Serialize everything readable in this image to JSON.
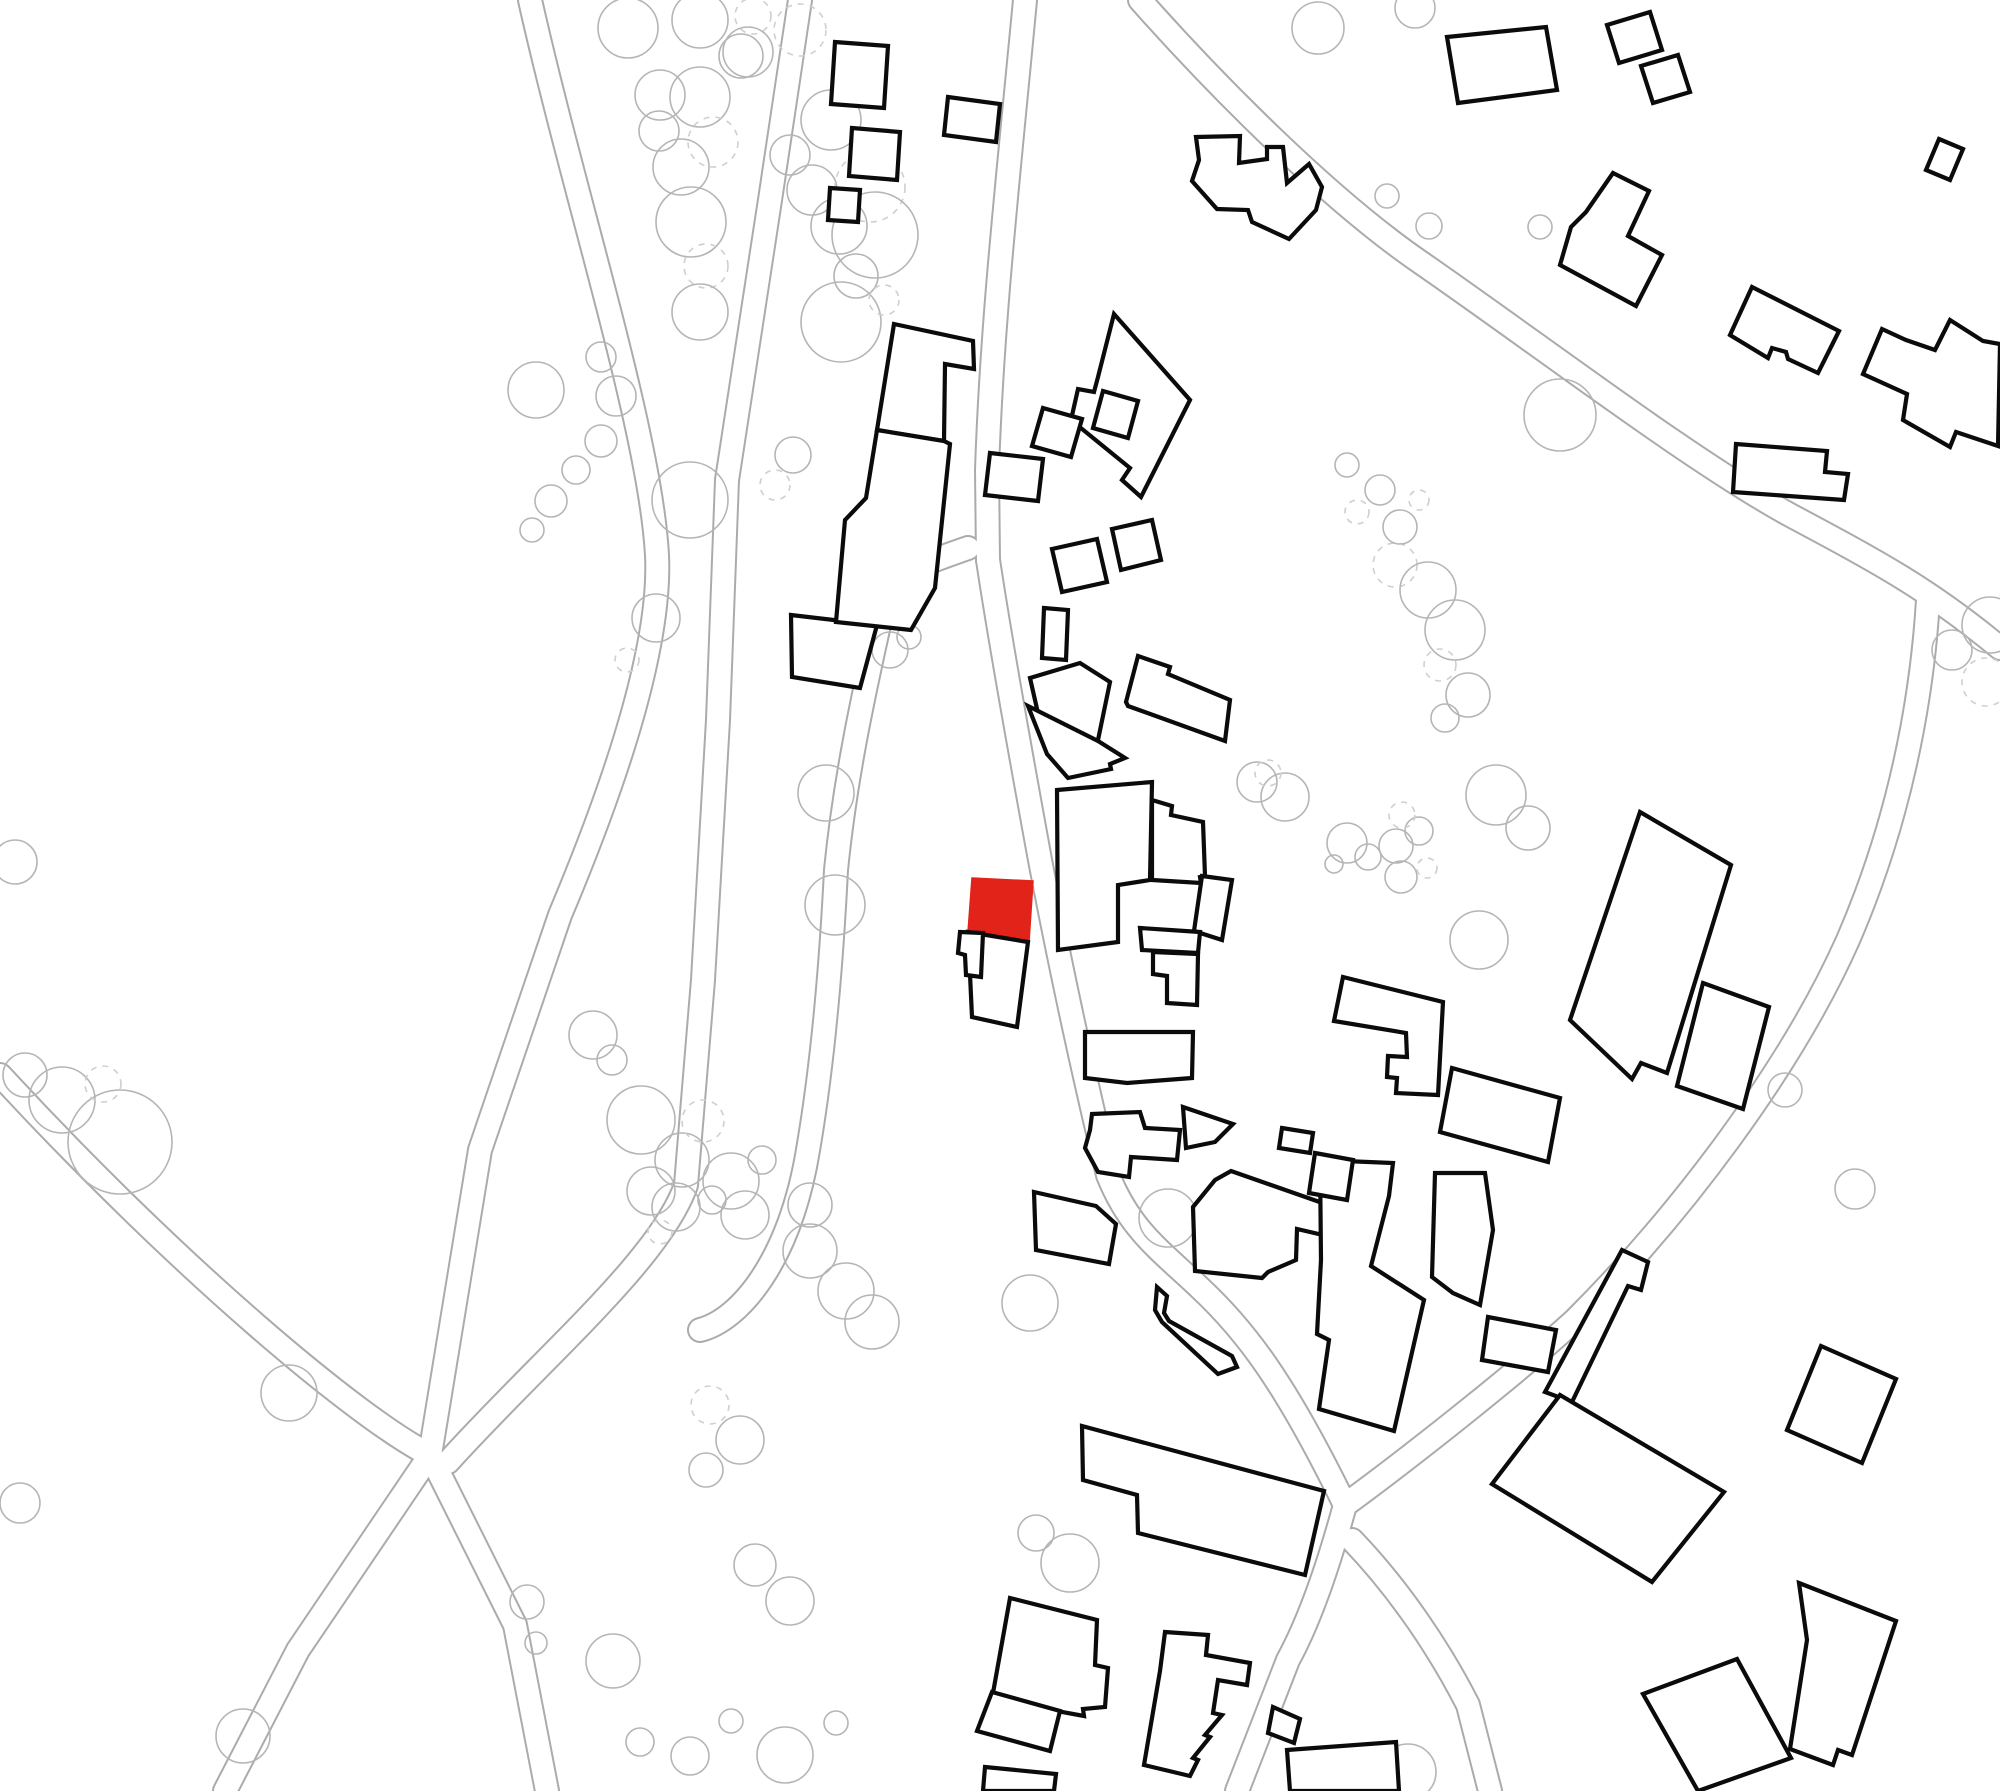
{
  "map": {
    "width": 2000,
    "height": 1791,
    "background": "#ffffff",
    "building_fill": "#ffffff",
    "building_outline_color": "#0b0b0b",
    "building_outline_width": 4.2,
    "highlight_fill": "#e2231a",
    "road_edge_color": "#ababab",
    "road_casing_width": 26,
    "road_inner_width": 22,
    "tree_color": "#b5b5b5",
    "tree_dashed_color": "#cfcfcf",
    "tree_stroke_width": 1.6,
    "tree_dash_pattern": "6 6"
  },
  "roads": [
    {
      "name": "road-west-main",
      "d": "M530,0 C575,200 650,430 657,555 C662,660 600,820 560,915 L480,1150 L430,1455 L298,1650 L225,1791"
    },
    {
      "name": "road-west-branch-se",
      "d": "M430,1455 L515,1625 L547,1791"
    },
    {
      "name": "road-west-branch-nw",
      "d": "M430,1455 C360,1420 180,1270 0,1075"
    },
    {
      "name": "road-village-west",
      "d": "M800,0 L770,200 L727,480 L718,720 L703,980 L686,1185 C660,1260 540,1360 448,1462"
    },
    {
      "name": "road-village-north",
      "d": "M1025,0 C1008,180 992,320 987,470 L988,560"
    },
    {
      "name": "road-village-main",
      "d": "M988,560 C1000,640 1018,740 1040,860 C1062,975 1085,1080 1108,1175 C1130,1230 1160,1250 1200,1288 C1245,1330 1285,1382 1345,1505"
    },
    {
      "name": "road-village-lane",
      "d": "M968,548 C920,565 890,575 885,598 C862,700 845,780 836,870 C830,990 820,1080 808,1150 C790,1260 740,1320 700,1330"
    },
    {
      "name": "road-village-south",
      "d": "M1345,1505 C1330,1560 1310,1620 1288,1660 L1237,1791"
    },
    {
      "name": "road-northeast",
      "d": "M1345,1505 C1420,1450 1520,1370 1575,1320 C1680,1215 1790,1070 1848,940 C1900,820 1922,700 1928,600"
    },
    {
      "name": "road-top-diagonal",
      "d": "M1140,0 C1220,90 1330,200 1420,262 C1540,345 1690,460 1790,515 C1880,563 1930,590 2000,648"
    },
    {
      "name": "road-southeast-stub",
      "d": "M1352,1540 C1400,1590 1440,1650 1468,1705 L1490,1791"
    }
  ],
  "trees": [
    {
      "x": 628,
      "y": 28,
      "r": 30
    },
    {
      "x": 660,
      "y": 95,
      "r": 25
    },
    {
      "x": 700,
      "y": 20,
      "r": 28
    },
    {
      "x": 741,
      "y": 56,
      "r": 22
    },
    {
      "x": 753,
      "y": 16,
      "r": 18,
      "dashed": true
    },
    {
      "x": 700,
      "y": 97,
      "r": 30
    },
    {
      "x": 713,
      "y": 142,
      "r": 25,
      "dashed": true
    },
    {
      "x": 681,
      "y": 167,
      "r": 28
    },
    {
      "x": 659,
      "y": 131,
      "r": 20
    },
    {
      "x": 691,
      "y": 222,
      "r": 35
    },
    {
      "x": 706,
      "y": 266,
      "r": 22,
      "dashed": true
    },
    {
      "x": 700,
      "y": 312,
      "r": 28
    },
    {
      "x": 748,
      "y": 52,
      "r": 25
    },
    {
      "x": 800,
      "y": 30,
      "r": 26,
      "dashed": true
    },
    {
      "x": 831,
      "y": 120,
      "r": 30
    },
    {
      "x": 812,
      "y": 190,
      "r": 25
    },
    {
      "x": 790,
      "y": 155,
      "r": 20
    },
    {
      "x": 862,
      "y": 150,
      "r": 12
    },
    {
      "x": 870,
      "y": 187,
      "r": 35,
      "dashed": true
    },
    {
      "x": 839,
      "y": 226,
      "r": 28
    },
    {
      "x": 856,
      "y": 276,
      "r": 22
    },
    {
      "x": 841,
      "y": 322,
      "r": 40
    },
    {
      "x": 884,
      "y": 300,
      "r": 15,
      "dashed": true
    },
    {
      "x": 875,
      "y": 235,
      "r": 43
    },
    {
      "x": 536,
      "y": 390,
      "r": 28
    },
    {
      "x": 601,
      "y": 357,
      "r": 15
    },
    {
      "x": 616,
      "y": 396,
      "r": 20
    },
    {
      "x": 601,
      "y": 441,
      "r": 16
    },
    {
      "x": 576,
      "y": 470,
      "r": 14
    },
    {
      "x": 551,
      "y": 501,
      "r": 16
    },
    {
      "x": 532,
      "y": 530,
      "r": 12
    },
    {
      "x": 656,
      "y": 618,
      "r": 24
    },
    {
      "x": 627,
      "y": 660,
      "r": 12,
      "dashed": true
    },
    {
      "x": 890,
      "y": 650,
      "r": 18
    },
    {
      "x": 909,
      "y": 637,
      "r": 12
    },
    {
      "x": 826,
      "y": 793,
      "r": 28
    },
    {
      "x": 690,
      "y": 500,
      "r": 38
    },
    {
      "x": 793,
      "y": 455,
      "r": 18
    },
    {
      "x": 775,
      "y": 485,
      "r": 15,
      "dashed": true
    },
    {
      "x": 835,
      "y": 905,
      "r": 30
    },
    {
      "x": 593,
      "y": 1035,
      "r": 24
    },
    {
      "x": 612,
      "y": 1060,
      "r": 15
    },
    {
      "x": 641,
      "y": 1120,
      "r": 34
    },
    {
      "x": 682,
      "y": 1160,
      "r": 27
    },
    {
      "x": 703,
      "y": 1121,
      "r": 21,
      "dashed": true
    },
    {
      "x": 651,
      "y": 1191,
      "r": 24
    },
    {
      "x": 731,
      "y": 1181,
      "r": 28
    },
    {
      "x": 762,
      "y": 1160,
      "r": 14
    },
    {
      "x": 810,
      "y": 1205,
      "r": 22
    },
    {
      "x": 1257,
      "y": 782,
      "r": 20
    },
    {
      "x": 1285,
      "y": 797,
      "r": 24
    },
    {
      "x": 1268,
      "y": 773,
      "r": 13,
      "dashed": true
    },
    {
      "x": 1347,
      "y": 843,
      "r": 20
    },
    {
      "x": 1368,
      "y": 857,
      "r": 13
    },
    {
      "x": 1396,
      "y": 846,
      "r": 17
    },
    {
      "x": 1419,
      "y": 831,
      "r": 14
    },
    {
      "x": 1402,
      "y": 815,
      "r": 13,
      "dashed": true
    },
    {
      "x": 1401,
      "y": 877,
      "r": 16
    },
    {
      "x": 1427,
      "y": 868,
      "r": 10,
      "dashed": true
    },
    {
      "x": 1479,
      "y": 940,
      "r": 29
    },
    {
      "x": 1334,
      "y": 864,
      "r": 9
    },
    {
      "x": 1395,
      "y": 565,
      "r": 22,
      "dashed": true
    },
    {
      "x": 1428,
      "y": 590,
      "r": 28
    },
    {
      "x": 1455,
      "y": 630,
      "r": 30
    },
    {
      "x": 1440,
      "y": 665,
      "r": 16,
      "dashed": true
    },
    {
      "x": 1468,
      "y": 695,
      "r": 22
    },
    {
      "x": 1445,
      "y": 718,
      "r": 14
    },
    {
      "x": 1496,
      "y": 795,
      "r": 30
    },
    {
      "x": 1528,
      "y": 828,
      "r": 22
    },
    {
      "x": 1318,
      "y": 28,
      "r": 26
    },
    {
      "x": 1415,
      "y": 8,
      "r": 20
    },
    {
      "x": 1387,
      "y": 196,
      "r": 12
    },
    {
      "x": 1429,
      "y": 226,
      "r": 13
    },
    {
      "x": 1540,
      "y": 227,
      "r": 12
    },
    {
      "x": 1560,
      "y": 415,
      "r": 36
    },
    {
      "x": 1347,
      "y": 465,
      "r": 12
    },
    {
      "x": 1380,
      "y": 490,
      "r": 15
    },
    {
      "x": 1357,
      "y": 512,
      "r": 12,
      "dashed": true
    },
    {
      "x": 1400,
      "y": 527,
      "r": 17
    },
    {
      "x": 1419,
      "y": 500,
      "r": 10,
      "dashed": true
    },
    {
      "x": 1990,
      "y": 625,
      "r": 28
    },
    {
      "x": 1952,
      "y": 650,
      "r": 20
    },
    {
      "x": 1986,
      "y": 682,
      "r": 24,
      "dashed": true
    },
    {
      "x": 1785,
      "y": 1090,
      "r": 17
    },
    {
      "x": 1855,
      "y": 1189,
      "r": 20
    },
    {
      "x": 15,
      "y": 862,
      "r": 22
    },
    {
      "x": 25,
      "y": 1075,
      "r": 22
    },
    {
      "x": 62,
      "y": 1100,
      "r": 33
    },
    {
      "x": 120,
      "y": 1142,
      "r": 52
    },
    {
      "x": 103,
      "y": 1084,
      "r": 18,
      "dashed": true
    },
    {
      "x": 289,
      "y": 1393,
      "r": 28
    },
    {
      "x": 20,
      "y": 1503,
      "r": 20
    },
    {
      "x": 243,
      "y": 1736,
      "r": 27
    },
    {
      "x": 527,
      "y": 1602,
      "r": 17
    },
    {
      "x": 536,
      "y": 1643,
      "r": 11
    },
    {
      "x": 613,
      "y": 1661,
      "r": 27
    },
    {
      "x": 640,
      "y": 1742,
      "r": 14
    },
    {
      "x": 690,
      "y": 1756,
      "r": 19
    },
    {
      "x": 676,
      "y": 1207,
      "r": 24
    },
    {
      "x": 660,
      "y": 1232,
      "r": 12,
      "dashed": true
    },
    {
      "x": 745,
      "y": 1215,
      "r": 24
    },
    {
      "x": 712,
      "y": 1200,
      "r": 14
    },
    {
      "x": 810,
      "y": 1251,
      "r": 27
    },
    {
      "x": 846,
      "y": 1291,
      "r": 28
    },
    {
      "x": 872,
      "y": 1322,
      "r": 27
    },
    {
      "x": 1030,
      "y": 1303,
      "r": 28
    },
    {
      "x": 710,
      "y": 1405,
      "r": 19,
      "dashed": true
    },
    {
      "x": 740,
      "y": 1440,
      "r": 24
    },
    {
      "x": 706,
      "y": 1470,
      "r": 17
    },
    {
      "x": 755,
      "y": 1565,
      "r": 21
    },
    {
      "x": 790,
      "y": 1601,
      "r": 24
    },
    {
      "x": 785,
      "y": 1755,
      "r": 28
    },
    {
      "x": 731,
      "y": 1721,
      "r": 12
    },
    {
      "x": 836,
      "y": 1723,
      "r": 12
    },
    {
      "x": 1036,
      "y": 1533,
      "r": 18
    },
    {
      "x": 1070,
      "y": 1563,
      "r": 29
    },
    {
      "x": 1168,
      "y": 1218,
      "r": 29
    },
    {
      "x": 1408,
      "y": 1772,
      "r": 28
    }
  ],
  "buildings": [
    {
      "name": "building-sq-top-1",
      "points": "835,42 888,46 884,108 831,104"
    },
    {
      "name": "building-sq-top-2",
      "points": "852,128 900,132 897,180 849,176"
    },
    {
      "name": "building-sq-top-3",
      "points": "830,188 860,190 858,222 828,220"
    },
    {
      "name": "building-north-small",
      "points": "948,97 1000,104 996,142 944,135"
    },
    {
      "name": "building-zigzag-north",
      "points": "1196,137 1240,136 1239,163 1267,159 1267,147 1283,147 1287,183 1309,164 1322,187 1316,210 1289,239 1252,222 1248,210 1217,209 1192,181 1199,160"
    },
    {
      "name": "building-long-rect-ne",
      "points": "1447,37 1546,27 1557,90 1458,103"
    },
    {
      "name": "building-pair-sq-1",
      "points": "1607,25 1650,12 1662,50 1619,63"
    },
    {
      "name": "building-pair-sq-2",
      "points": "1641,66 1678,55 1690,92 1653,103"
    },
    {
      "name": "building-corner-small",
      "points": "1939,139 1963,149 1950,180 1926,170"
    },
    {
      "name": "building-stepped-house-ne",
      "points": "1613,173 1649,191 1628,236 1662,255 1636,306 1560,265 1571,227 1586,212"
    },
    {
      "name": "building-house-ne-center",
      "points": "1752,287 1839,331 1818,373 1788,359 1786,352 1772,348 1768,358 1730,335"
    },
    {
      "name": "building-gable-house-east",
      "points": "1882,329 1906,340 1935,350 1950,320 1983,341 2000,344 1998,446 1956,432 1950,447 1903,420 1907,394 1863,374"
    },
    {
      "name": "building-step-east",
      "points": "1736,444 1827,451 1825,472 1848,474 1844,500 1733,492"
    },
    {
      "name": "building-large-east-house",
      "points": "1114,314 1190,400 1141,497 1122,480 1130,468 1071,420 1078,389 1094,392 1098,377"
    },
    {
      "name": "building-small-sq-a",
      "points": "1043,408 1082,419 1071,457 1032,446"
    },
    {
      "name": "building-small-sq-b",
      "points": "1103,391 1138,401 1128,438 1093,428"
    },
    {
      "name": "building-small-sq-c",
      "points": "990,453 1043,459 1038,501 985,495"
    },
    {
      "name": "building-small-sq-d",
      "points": "1052,549 1097,539 1107,582 1062,592"
    },
    {
      "name": "building-small-sq-e",
      "points": "1112,529 1152,520 1161,560 1121,570"
    },
    {
      "name": "building-west-quad",
      "points": "791,615 877,625 860,688 792,677"
    },
    {
      "name": "building-center-tall-upper",
      "points": "894,324 973,341 974,369 945,364 944,441 877,430"
    },
    {
      "name": "building-center-tall-lower",
      "points": "877,430 944,441 950,444 935,588 911,630 836,622 845,520 866,498"
    },
    {
      "name": "building-pair-mid-upper",
      "points": "1030,678 1080,663 1110,682 1098,740 1047,753"
    },
    {
      "name": "building-pair-mid-lower",
      "points": "1028,706 1098,741 1125,758 1110,764 1111,769 1068,778 1047,754"
    },
    {
      "name": "building-stepped-mid-ne",
      "points": "1126,702 1138,656 1170,667 1168,674 1230,700 1225,741 1128,706"
    },
    {
      "name": "building-small-vert-rect",
      "points": "1044,608 1068,610 1066,660 1042,658"
    },
    {
      "name": "building-highlight",
      "points": "972,878 1033,881 1029,942 968,932",
      "highlighted": true
    },
    {
      "name": "building-below-highlight",
      "points": "968,932 1028,942 1017,1027 972,1017"
    },
    {
      "name": "building-annex-west",
      "points": "960,932 983,933 981,977 966,975 965,955 958,953"
    },
    {
      "name": "building-east-block-1",
      "points": "1057,790 1152,782 1150,880 1118,885 1118,942 1058,950"
    },
    {
      "name": "building-east-block-2",
      "points": "1152,800 1172,806 1171,815 1203,822 1205,876 1200,877 1201,883 1152,880"
    },
    {
      "name": "building-east-annex-tilt",
      "points": "1202,876 1232,880 1222,940 1194,931"
    },
    {
      "name": "building-east-mid-rect",
      "points": "1140,928 1200,932 1198,953 1142,950"
    },
    {
      "name": "building-east-mid-step",
      "points": "1153,952 1198,954 1197,1005 1167,1003 1167,976 1153,974"
    },
    {
      "name": "building-east-low-wide",
      "points": "1085,1032 1193,1032 1192,1078 1127,1083 1085,1078"
    },
    {
      "name": "building-small-tri",
      "points": "1183,1107 1233,1124 1215,1142 1186,1148"
    },
    {
      "name": "building-stepped-south",
      "points": "1092,1114 1140,1112 1145,1128 1180,1130 1177,1160 1131,1157 1129,1177 1098,1172 1085,1148 1090,1130"
    },
    {
      "name": "building-trapezoid",
      "points": "1034,1192 1096,1206 1116,1224 1109,1264 1036,1250"
    },
    {
      "name": "building-barn-ne",
      "points": "1570,1020 1640,812 1731,865 1667,1073 1641,1063 1632,1079"
    },
    {
      "name": "building-barn-annex",
      "points": "1703,983 1769,1007 1743,1109 1677,1086"
    },
    {
      "name": "building-long-house",
      "points": "1343,977 1443,1002 1438,1095 1396,1093 1397,1078 1387,1077 1388,1056 1407,1057 1406,1033 1334,1021"
    },
    {
      "name": "building-long-house-se",
      "points": "1452,1068 1560,1098 1548,1162 1440,1132"
    },
    {
      "name": "building-cluster-h1",
      "points": "1231,1171 1331,1206 1323,1235 1297,1229 1296,1260 1268,1272 1262,1278 1195,1271 1193,1207 1215,1180"
    },
    {
      "name": "building-cluster-h2",
      "points": "1320,1160 1393,1163 1389,1196 1371,1266 1424,1300 1394,1431 1319,1409 1329,1340 1317,1334 1321,1260"
    },
    {
      "name": "building-cluster-h3",
      "points": "1435,1173 1485,1173 1493,1230 1480,1305 1453,1293 1432,1277"
    },
    {
      "name": "building-diagonal-bar",
      "points": "1157,1287 1167,1296 1164,1313 1169,1321 1232,1356 1237,1367 1218,1374 1162,1322 1155,1310"
    },
    {
      "name": "building-small-rect-s",
      "points": "1282,1128 1313,1133 1310,1153 1279,1148"
    },
    {
      "name": "building-small-quad-s",
      "points": "1315,1153 1353,1160 1347,1200 1309,1193"
    },
    {
      "name": "building-cluster-k",
      "points": "1488,1317 1556,1330 1548,1372 1482,1360"
    },
    {
      "name": "building-big-south",
      "points": "1082,1426 1324,1491 1305,1575 1138,1533 1137,1495 1083,1480"
    },
    {
      "name": "building-bottom-u1",
      "points": "1010,1598 1097,1620 1095,1665 1108,1668 1105,1707 1083,1709 1084,1716 1062,1712 993,1693"
    },
    {
      "name": "building-bottom-u2",
      "points": "992,1692 1060,1711 1050,1751 977,1731"
    },
    {
      "name": "building-bottom-u3",
      "points": "985,1767 1056,1774 1054,1791 983,1791"
    },
    {
      "name": "building-bottom-stepped",
      "points": "1165,1632 1208,1635 1206,1655 1250,1663 1247,1685 1218,1680 1213,1713 1222,1715 1205,1735 1210,1737 1193,1758 1198,1760 1190,1776 1144,1765 1160,1671"
    },
    {
      "name": "building-bottom-bit",
      "points": "1273,1707 1300,1719 1294,1743 1268,1733"
    },
    {
      "name": "building-bottom-right-clip",
      "points": "1287,1750 1396,1742 1399,1791 1290,1791"
    },
    {
      "name": "building-l-arm",
      "points": "1622,1250 1648,1262 1641,1290 1628,1286 1572,1402 1545,1392"
    },
    {
      "name": "building-l-base",
      "points": "1492,1484 1560,1395 1724,1492 1652,1582"
    },
    {
      "name": "building-rot-square-se",
      "points": "1821,1346 1896,1379 1862,1463 1787,1430"
    },
    {
      "name": "building-bottom-se",
      "points": "1799,1583 1896,1621 1852,1755 1838,1750 1833,1765 1790,1749 1807,1640"
    },
    {
      "name": "building-bottom-tilt",
      "points": "1643,1694 1737,1659 1791,1758 1698,1791"
    }
  ]
}
